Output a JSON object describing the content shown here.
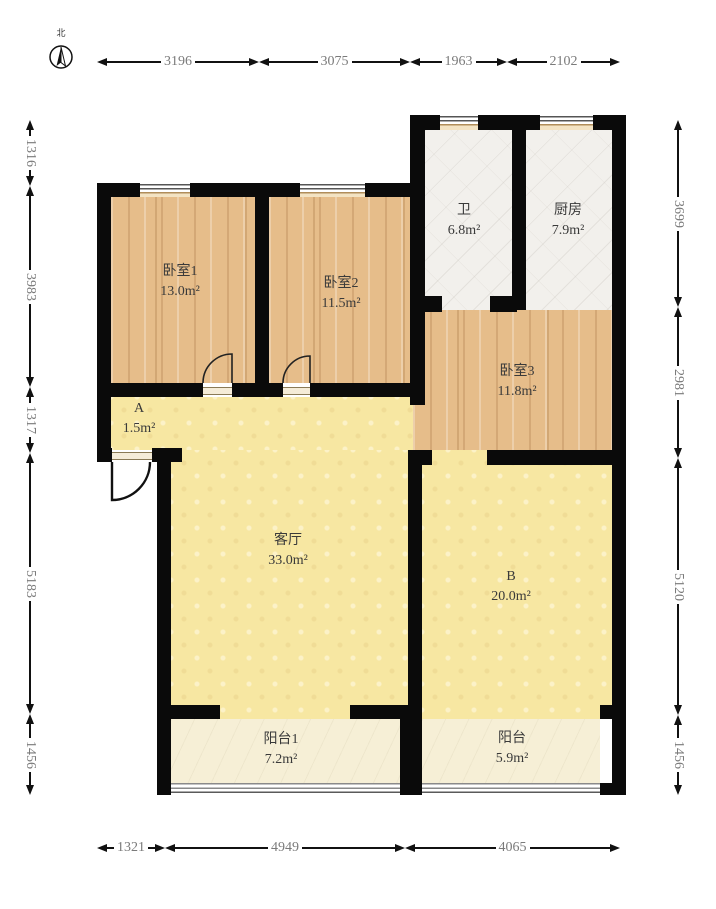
{
  "palette": {
    "wall": "#0a0a0a",
    "wood_floor": "#e6bd8a",
    "tile_floor": "#f2f0ec",
    "yellow_floor": "#f7e7a2",
    "balcony_floor": "#f6efd6",
    "dimension_text": "#7a7a7a",
    "label_text": "#3a3a3a"
  },
  "compass": {
    "label": "北"
  },
  "rooms": [
    {
      "id": "bedroom1",
      "name": "卧室1",
      "area": "13.0m²"
    },
    {
      "id": "bedroom2",
      "name": "卧室2",
      "area": "11.5m²"
    },
    {
      "id": "bath",
      "name": "卫",
      "area": "6.8m²"
    },
    {
      "id": "kitchen",
      "name": "厨房",
      "area": "7.9m²"
    },
    {
      "id": "bedroom3",
      "name": "卧室3",
      "area": "11.8m²"
    },
    {
      "id": "area-a",
      "name": "A",
      "area": "1.5m²"
    },
    {
      "id": "living-room",
      "name": "客厅",
      "area": "33.0m²"
    },
    {
      "id": "area-b",
      "name": "B",
      "area": "20.0m²"
    },
    {
      "id": "balcony1",
      "name": "阳台1",
      "area": "7.2m²"
    },
    {
      "id": "balcony2",
      "name": "阳台",
      "area": "5.9m²"
    }
  ],
  "dimensions": {
    "top": [
      "3196",
      "3075",
      "1963",
      "2102"
    ],
    "bottom": [
      "1321",
      "4949",
      "4065"
    ],
    "left": [
      "1316",
      "3983",
      "1317",
      "5183",
      "1456"
    ],
    "right": [
      "3699",
      "2981",
      "5120",
      "1456"
    ]
  }
}
